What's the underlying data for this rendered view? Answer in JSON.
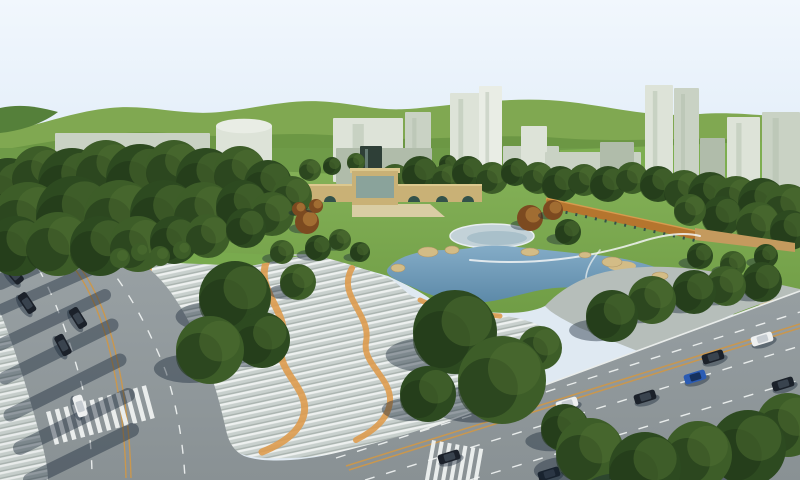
{
  "meta": {
    "app": "park-master-plan-aerial-rendering",
    "width": 800,
    "height": 480
  },
  "palette": {
    "sky_top": "#f1f7fd",
    "sky_bottom": "#e3eef9",
    "hill_far": "#80a851",
    "hill_near": "#6c9744",
    "hill_dark": "#55803a",
    "hill_bright": "#7dae50",
    "grass_bg": "#6f9b48",
    "lawn_top": "#85b258",
    "lawn_bottom": "#6f9c45",
    "verge": "#79aa4e",
    "forest_tone0": "#2d4a20",
    "forest_tone1": "#3d5d28",
    "forest_light": "#4f7031",
    "forest_dark": "#1f3418",
    "water_top": "#84acc7",
    "water_bottom": "#5c89a8",
    "sand": "#d3bc86",
    "rock_edge": "#b09768",
    "plaza_base": "#c8d0cd",
    "plaza_stripe_light": "#eef1f0",
    "plaza_stripe_dark": "#a9b2ae",
    "plaza_orange": "#de9c4f",
    "plaza_plain": "#b6beba",
    "road_top": "#9aa2a5",
    "road_bottom": "#899194",
    "marking": "#f2f5f4",
    "centerline": "#c9974e",
    "curb": "#e9ecea",
    "bridge_tan": "#c9b176",
    "bridge_cap": "#dcc88e",
    "arch_dark": "#33524a",
    "steps": "#d9cda4",
    "pavilion_glass": "#8aa39b",
    "colonnade": "#b5752e",
    "colonnade_hi": "#d79a4e",
    "deck": "#c49a5e",
    "building_light": "#dde3d8",
    "building_xlight": "#e9ede5",
    "building_mid": "#c9d2c4",
    "building_shade": "#b0bcaa",
    "tower_dark": "#2e3f37",
    "shadow": "rgba(24,38,54,0.42)",
    "beach": "#c3d2d8",
    "beach_rim": "#e8eef0",
    "beach_inner": "#a9c0ca",
    "car_white": "#eef0f0",
    "car_black": "#1b212a",
    "car_blue": "#2b5cb4"
  },
  "scene": {
    "buildings": [
      {
        "x": 55,
        "y": 133,
        "w": 155,
        "h": 50,
        "f": "building_mid",
        "shape": "box"
      },
      {
        "x": 216,
        "y": 126,
        "w": 56,
        "h": 54,
        "f": "building_light",
        "shape": "cyl"
      },
      {
        "x": 333,
        "y": 118,
        "w": 70,
        "h": 64,
        "f": "building_light",
        "shape": "box"
      },
      {
        "x": 405,
        "y": 112,
        "w": 26,
        "h": 70,
        "f": "building_mid",
        "shape": "box"
      },
      {
        "x": 336,
        "y": 148,
        "w": 96,
        "h": 36,
        "f": "building_shade",
        "shape": "box"
      },
      {
        "x": 450,
        "y": 93,
        "w": 30,
        "h": 87,
        "f": "building_light",
        "shape": "box"
      },
      {
        "x": 479,
        "y": 86,
        "w": 23,
        "h": 94,
        "f": "building_xlight",
        "shape": "box"
      },
      {
        "x": 503,
        "y": 146,
        "w": 56,
        "h": 38,
        "f": "building_mid",
        "shape": "box"
      },
      {
        "x": 521,
        "y": 126,
        "w": 26,
        "h": 58,
        "f": "building_light",
        "shape": "box"
      },
      {
        "x": 545,
        "y": 152,
        "w": 96,
        "h": 33,
        "f": "building_mid",
        "shape": "box"
      },
      {
        "x": 600,
        "y": 142,
        "w": 34,
        "h": 44,
        "f": "building_shade",
        "shape": "box"
      },
      {
        "x": 645,
        "y": 85,
        "w": 28,
        "h": 95,
        "f": "building_light",
        "shape": "box"
      },
      {
        "x": 674,
        "y": 88,
        "w": 25,
        "h": 92,
        "f": "building_mid",
        "shape": "box"
      },
      {
        "x": 700,
        "y": 138,
        "w": 25,
        "h": 48,
        "f": "building_shade",
        "shape": "box"
      },
      {
        "x": 727,
        "y": 117,
        "w": 33,
        "h": 70,
        "f": "building_light",
        "shape": "box"
      },
      {
        "x": 762,
        "y": 112,
        "w": 38,
        "h": 78,
        "f": "building_mid",
        "shape": "box"
      },
      {
        "x": 360,
        "y": 146,
        "w": 22,
        "h": 42,
        "f": "tower_dark",
        "shape": "box"
      }
    ],
    "forest_top": [
      [
        310,
        170,
        11,
        1
      ],
      [
        332,
        166,
        9,
        0
      ],
      [
        356,
        162,
        9,
        1
      ],
      [
        425,
        168,
        10,
        1
      ],
      [
        448,
        164,
        9,
        0
      ],
      [
        395,
        180,
        16,
        1
      ],
      [
        420,
        174,
        18,
        0
      ],
      [
        446,
        178,
        14,
        1
      ],
      [
        468,
        172,
        16,
        0
      ],
      [
        492,
        178,
        16,
        1
      ],
      [
        515,
        172,
        14,
        0
      ],
      [
        538,
        178,
        16,
        1
      ],
      [
        560,
        184,
        18,
        0
      ],
      [
        584,
        180,
        16,
        1
      ],
      [
        608,
        184,
        18,
        0
      ],
      [
        632,
        178,
        16,
        1
      ],
      [
        658,
        184,
        18,
        0
      ],
      [
        684,
        190,
        20,
        1
      ],
      [
        710,
        194,
        22,
        0
      ],
      [
        736,
        198,
        22,
        1
      ],
      [
        762,
        202,
        24,
        0
      ],
      [
        788,
        208,
        24,
        1
      ],
      [
        722,
        216,
        20,
        0
      ],
      [
        758,
        224,
        22,
        1
      ],
      [
        790,
        230,
        20,
        0
      ],
      [
        690,
        210,
        16,
        1
      ]
    ],
    "forest_left": [
      [
        8,
        192,
        34,
        0
      ],
      [
        40,
        174,
        28,
        1
      ],
      [
        72,
        182,
        34,
        0
      ],
      [
        106,
        170,
        30,
        1
      ],
      [
        140,
        178,
        34,
        0
      ],
      [
        174,
        168,
        28,
        1
      ],
      [
        206,
        178,
        30,
        0
      ],
      [
        240,
        172,
        26,
        1
      ],
      [
        268,
        184,
        24,
        0
      ],
      [
        292,
        196,
        20,
        1
      ],
      [
        28,
        218,
        36,
        1
      ],
      [
        74,
        214,
        38,
        0
      ],
      [
        120,
        216,
        36,
        1
      ],
      [
        164,
        214,
        34,
        0
      ],
      [
        204,
        212,
        30,
        1
      ],
      [
        242,
        206,
        26,
        0
      ],
      [
        272,
        214,
        22,
        1
      ],
      [
        16,
        246,
        30,
        0
      ],
      [
        58,
        244,
        32,
        1
      ],
      [
        100,
        246,
        30,
        0
      ],
      [
        138,
        244,
        28,
        1
      ],
      [
        174,
        240,
        24,
        0
      ],
      [
        208,
        236,
        22,
        1
      ],
      [
        246,
        228,
        20,
        0
      ]
    ],
    "trees": [
      [
        235,
        297,
        36,
        0
      ],
      [
        210,
        350,
        34,
        1
      ],
      [
        262,
        340,
        28,
        0
      ],
      [
        298,
        282,
        18,
        1
      ],
      [
        455,
        332,
        42,
        0
      ],
      [
        502,
        380,
        44,
        1
      ],
      [
        428,
        394,
        28,
        0
      ],
      [
        540,
        348,
        22,
        1
      ],
      [
        612,
        316,
        26,
        0
      ],
      [
        652,
        300,
        24,
        1
      ],
      [
        694,
        292,
        22,
        0
      ],
      [
        726,
        286,
        20,
        1
      ],
      [
        762,
        282,
        20,
        0
      ],
      [
        565,
        428,
        24,
        0
      ],
      [
        590,
        452,
        34,
        1
      ],
      [
        645,
        468,
        36,
        0
      ],
      [
        698,
        455,
        34,
        1
      ],
      [
        748,
        448,
        38,
        0
      ],
      [
        788,
        425,
        32,
        1
      ],
      [
        318,
        248,
        13,
        0
      ],
      [
        340,
        240,
        11,
        1
      ],
      [
        282,
        252,
        12,
        1
      ],
      [
        360,
        252,
        10,
        0
      ],
      [
        700,
        256,
        13,
        0
      ],
      [
        733,
        264,
        13,
        1
      ],
      [
        766,
        256,
        12,
        0
      ],
      [
        568,
        232,
        13,
        0
      ]
    ],
    "hedges": [
      [
        120,
        258,
        10
      ],
      [
        140,
        252,
        9
      ],
      [
        160,
        256,
        10
      ],
      [
        182,
        250,
        9
      ]
    ],
    "autumn": [
      [
        307,
        222,
        12
      ],
      [
        530,
        218,
        13
      ],
      [
        553,
        210,
        10
      ],
      [
        299,
        209,
        7
      ],
      [
        316,
        206,
        7
      ]
    ],
    "rocks": [
      [
        428,
        252,
        10,
        5
      ],
      [
        452,
        250,
        7,
        4
      ],
      [
        530,
        252,
        9,
        4
      ],
      [
        612,
        262,
        10,
        5
      ],
      [
        660,
        276,
        8,
        4
      ],
      [
        398,
        268,
        7,
        4
      ],
      [
        585,
        255,
        6,
        3
      ]
    ],
    "cars": {
      "left": [
        [
          40,
          256,
          "white",
          48
        ],
        [
          14,
          274,
          "black",
          50
        ],
        [
          27,
          303,
          "black",
          56
        ],
        [
          78,
          318,
          "black",
          58
        ],
        [
          63,
          345,
          "black",
          62
        ],
        [
          80,
          406,
          "white",
          72
        ]
      ],
      "right": [
        [
          762,
          339,
          "white",
          -17
        ],
        [
          713,
          357,
          "black",
          -17
        ],
        [
          695,
          377,
          "blue",
          -17
        ],
        [
          783,
          384,
          "black",
          -17
        ],
        [
          645,
          397,
          "black",
          -17
        ],
        [
          567,
          404,
          "white",
          -17
        ],
        [
          681,
          448,
          "black",
          -17
        ],
        [
          449,
          457,
          "black",
          -17
        ],
        [
          549,
          474,
          "black",
          -17
        ]
      ]
    }
  }
}
